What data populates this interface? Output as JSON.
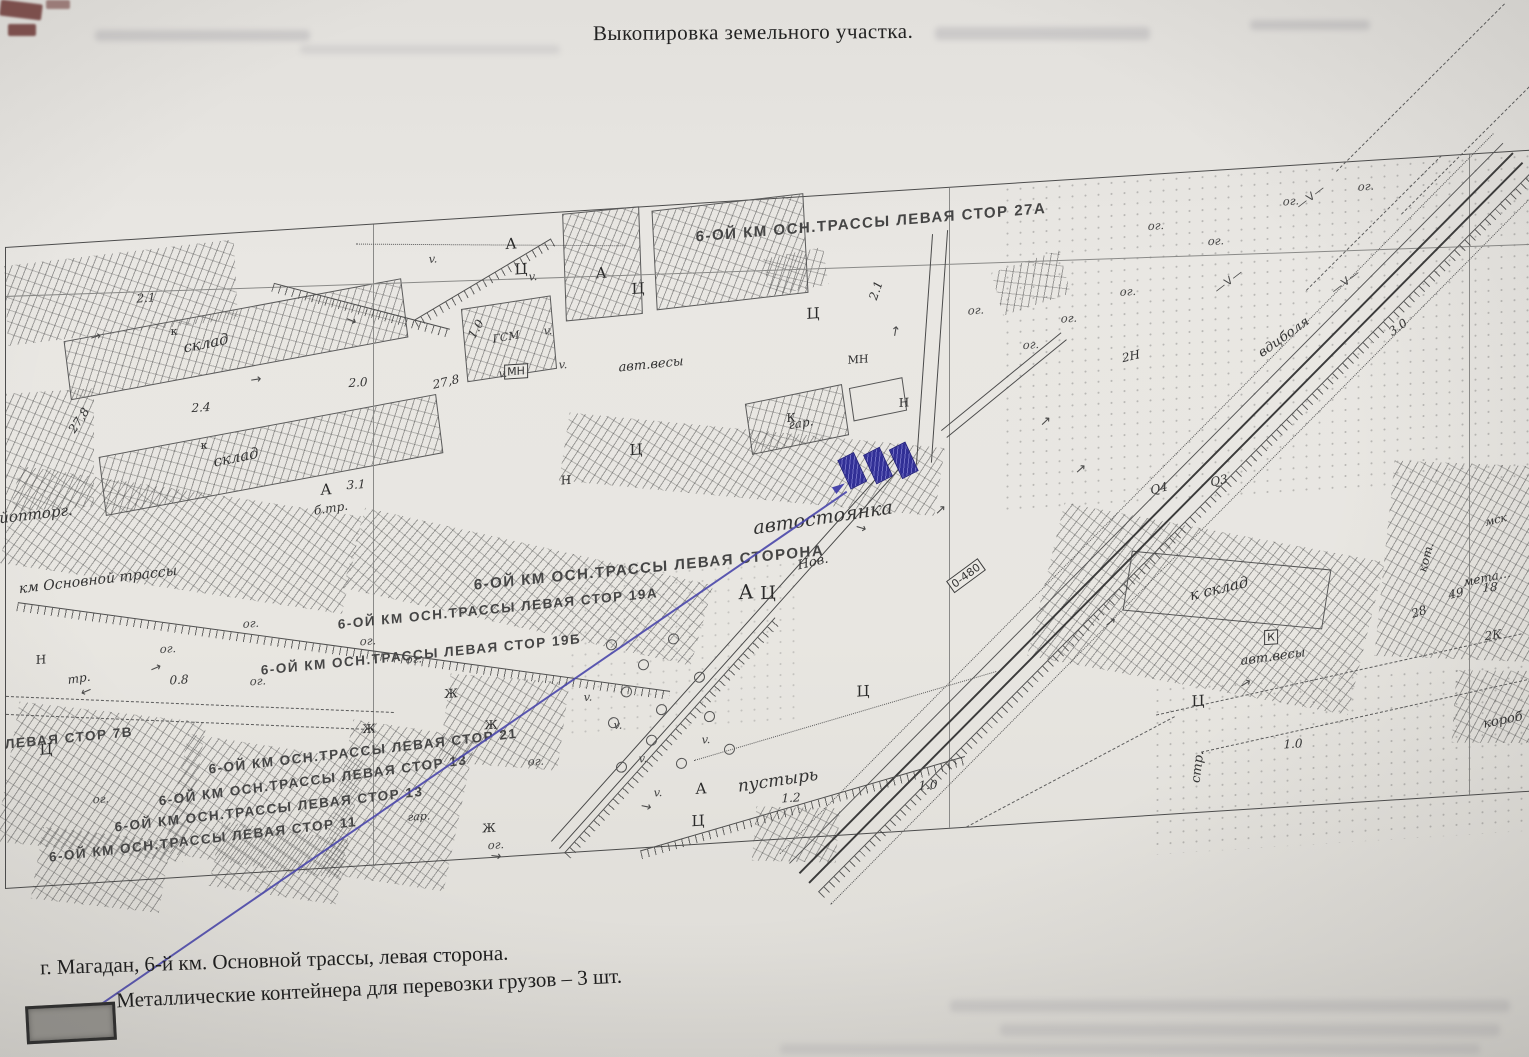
{
  "document": {
    "title": "Выкопировка земельного участка.",
    "footer_lines": [
      "г. Магадан, 6-й км. Основной трассы, левая сторона.",
      "Металлические контейнера для перевозки грузов – 3 шт."
    ]
  },
  "map": {
    "highlight": {
      "containers_count": 3,
      "fill_color": "#34319b",
      "pointer_color": "#4946ab"
    },
    "labels": [
      {
        "t": "6-ОЙ КМ ОСН.ТРАССЫ ЛЕВАЯ СТОР 27А",
        "x": 865,
        "y": 30,
        "r": -1,
        "s": 15,
        "c": "st"
      },
      {
        "t": "6-ОЙ КМ ОСН.ТРАССЫ ЛЕВАЯ СТОРОНА",
        "x": 643,
        "y": 361,
        "r": -2,
        "s": 15,
        "c": "st"
      },
      {
        "t": "6-ОЙ КМ ОСН.ТРАССЫ ЛЕВАЯ СТОР 19А",
        "x": 492,
        "y": 392,
        "r": -2,
        "s": 13.5,
        "c": "st"
      },
      {
        "t": "6-ОЙ КМ ОСН.ТРАССЫ ЛЕВАЯ СТОР 19Б",
        "x": 415,
        "y": 433,
        "r": -2,
        "s": 13.5,
        "c": "st"
      },
      {
        "t": "ЛЕВАЯ СТОР 7В",
        "x": 63,
        "y": 494,
        "r": -2,
        "s": 13.5,
        "c": "st"
      },
      {
        "t": "6-ОЙ КМ ОСН.ТРАССЫ ЛЕВАЯ СТОР 21",
        "x": 357,
        "y": 526,
        "r": -3,
        "s": 13.5,
        "c": "st"
      },
      {
        "t": "6-ОЙ КМ ОСН.ТРАССЫ ЛЕВАЯ СТОР 13",
        "x": 307,
        "y": 552,
        "r": -4,
        "s": 13.5,
        "c": "st"
      },
      {
        "t": "6-ОЙ КМ ОСН.ТРАССЫ ЛЕВАЯ СТОР 13",
        "x": 263,
        "y": 578,
        "r": -3,
        "s": 13.5,
        "c": "st"
      },
      {
        "t": "6-ОЙ КМ ОСН.ТРАССЫ ЛЕВАЯ СТОР 11",
        "x": 197,
        "y": 604,
        "r": -3,
        "s": 13.5,
        "c": "st"
      },
      {
        "t": "автостоянка",
        "x": 817,
        "y": 322,
        "r": -5,
        "s": 19,
        "c": "it"
      },
      {
        "t": "пустырь",
        "x": 772,
        "y": 582,
        "r": -5,
        "s": 17,
        "c": "it"
      },
      {
        "t": "склад",
        "x": 200,
        "y": 108,
        "r": -8,
        "s": 15,
        "c": "it"
      },
      {
        "t": "склад",
        "x": 230,
        "y": 224,
        "r": -8,
        "s": 15,
        "c": "it"
      },
      {
        "t": "к склад",
        "x": 1213,
        "y": 418,
        "r": -10,
        "s": 15,
        "c": "it"
      },
      {
        "t": "км Основной трассы",
        "x": 92,
        "y": 338,
        "r": -3,
        "s": 14,
        "c": "it"
      },
      {
        "t": "авт.весы",
        "x": 645,
        "y": 158,
        "r": -2,
        "s": 13,
        "c": "it"
      },
      {
        "t": "авт.весы",
        "x": 1267,
        "y": 490,
        "r": -4,
        "s": 13,
        "c": "it"
      },
      {
        "t": "гар.",
        "x": 795,
        "y": 226,
        "r": -6,
        "s": 12,
        "c": "it"
      },
      {
        "t": "гар.",
        "x": 413,
        "y": 595,
        "r": 0,
        "s": 11,
        "c": "it"
      },
      {
        "t": "Нов.",
        "x": 807,
        "y": 366,
        "r": -10,
        "s": 13,
        "c": "it"
      },
      {
        "t": "стр.",
        "x": 1192,
        "y": 595,
        "r": -83,
        "s": 13,
        "c": "it"
      },
      {
        "t": "тр.",
        "x": 73,
        "y": 435,
        "r": -5,
        "s": 12,
        "c": "it"
      },
      {
        "t": "б.тр.",
        "x": 325,
        "y": 281,
        "r": -5,
        "s": 12,
        "c": "it"
      },
      {
        "t": "йопторг.",
        "x": 30,
        "y": 268,
        "r": -3,
        "s": 15,
        "c": "it"
      },
      {
        "t": "ГСМ",
        "x": 500,
        "y": 121,
        "r": -6,
        "s": 11,
        "c": "it"
      },
      {
        "t": "кот.",
        "x": 1420,
        "y": 400,
        "r": -75,
        "s": 12,
        "c": "it"
      },
      {
        "t": "мск",
        "x": 1490,
        "y": 367,
        "r": -10,
        "s": 11,
        "c": "it"
      },
      {
        "t": "мета…",
        "x": 1481,
        "y": 424,
        "r": -8,
        "s": 12,
        "c": "it"
      },
      {
        "t": "короб",
        "x": 1497,
        "y": 568,
        "r": -8,
        "s": 13,
        "c": "it"
      },
      {
        "t": "вдцболя",
        "x": 1278,
        "y": 171,
        "r": -33,
        "s": 13,
        "c": "it"
      },
      {
        "t": "2.1",
        "x": 140,
        "y": 59,
        "c": "num"
      },
      {
        "t": "2.4",
        "x": 195,
        "y": 172,
        "c": "num"
      },
      {
        "t": "2.0",
        "x": 352,
        "y": 157,
        "c": "num"
      },
      {
        "t": "3.1",
        "x": 350,
        "y": 259,
        "c": "num"
      },
      {
        "t": "27,8",
        "x": 73,
        "y": 177,
        "r": -55,
        "c": "num"
      },
      {
        "t": "27,8",
        "x": 440,
        "y": 162,
        "r": -10,
        "c": "num"
      },
      {
        "t": "1.0",
        "x": 470,
        "y": 111,
        "r": -60,
        "c": "num"
      },
      {
        "t": "2.1",
        "x": 870,
        "y": 98,
        "r": -70,
        "c": "num"
      },
      {
        "t": "0.8",
        "x": 173,
        "y": 443,
        "c": "num"
      },
      {
        "t": "1.0",
        "x": 922,
        "y": 596,
        "c": "num"
      },
      {
        "t": "1.0",
        "x": 1287,
        "y": 578,
        "c": "num"
      },
      {
        "t": "1.2",
        "x": 785,
        "y": 600,
        "c": "num"
      },
      {
        "t": "3.0",
        "x": 1392,
        "y": 168,
        "r": -33,
        "c": "num"
      },
      {
        "t": "2Н",
        "x": 1125,
        "y": 180,
        "r": -10,
        "c": "num"
      },
      {
        "t": "28",
        "x": 1413,
        "y": 454,
        "r": -15,
        "c": "num"
      },
      {
        "t": "49",
        "x": 1450,
        "y": 438,
        "r": -10,
        "c": "num"
      },
      {
        "t": "18",
        "x": 1484,
        "y": 434,
        "c": "num"
      },
      {
        "t": "2К",
        "x": 1487,
        "y": 482,
        "r": -5,
        "c": "num"
      },
      {
        "t": "Q4",
        "x": 1153,
        "y": 314,
        "r": -10,
        "c": "num"
      },
      {
        "t": "Q3",
        "x": 1213,
        "y": 310,
        "r": -10,
        "c": "num"
      },
      {
        "t": "0-480",
        "x": 960,
        "y": 389,
        "r": -34,
        "c": "box"
      },
      {
        "t": "МН",
        "x": 510,
        "y": 156,
        "c": "box"
      },
      {
        "t": "К",
        "x": 1265,
        "y": 470,
        "c": "box"
      },
      {
        "t": "А",
        "x": 505,
        "y": 28,
        "c": "ltr"
      },
      {
        "t": "А",
        "x": 595,
        "y": 63,
        "c": "ltr"
      },
      {
        "t": "А",
        "x": 320,
        "y": 262,
        "c": "ltr"
      },
      {
        "t": "А",
        "x": 740,
        "y": 391,
        "s": 20,
        "c": "ltr"
      },
      {
        "t": "А",
        "x": 695,
        "y": 585,
        "c": "ltr"
      },
      {
        "t": "Ц",
        "x": 515,
        "y": 54,
        "c": "ltr"
      },
      {
        "t": "Ц",
        "x": 632,
        "y": 81,
        "c": "ltr"
      },
      {
        "t": "Ц",
        "x": 807,
        "y": 117,
        "c": "ltr"
      },
      {
        "t": "Ц",
        "x": 630,
        "y": 242,
        "c": "ltr"
      },
      {
        "t": "Ц",
        "x": 762,
        "y": 394,
        "s": 18,
        "c": "ltr"
      },
      {
        "t": "Ц",
        "x": 692,
        "y": 617,
        "c": "ltr"
      },
      {
        "t": "Ц",
        "x": 857,
        "y": 498,
        "c": "ltr"
      },
      {
        "t": "Ц",
        "x": 1192,
        "y": 529,
        "c": "ltr"
      },
      {
        "t": "Ц",
        "x": 40,
        "y": 504,
        "c": "ltr"
      },
      {
        "t": "Ж",
        "x": 363,
        "y": 504,
        "s": 12,
        "c": "ltr"
      },
      {
        "t": "Ж",
        "x": 485,
        "y": 508,
        "s": 12,
        "c": "ltr"
      },
      {
        "t": "Ж",
        "x": 483,
        "y": 611,
        "s": 12,
        "c": "ltr"
      },
      {
        "t": "Ж",
        "x": 445,
        "y": 474,
        "s": 12,
        "c": "ltr"
      },
      {
        "t": "Н",
        "x": 35,
        "y": 414,
        "s": 12,
        "c": "ltr"
      },
      {
        "t": "Н",
        "x": 898,
        "y": 212,
        "s": 12,
        "c": "ltr"
      },
      {
        "t": "Н",
        "x": 560,
        "y": 268,
        "s": 12,
        "c": "ltr"
      },
      {
        "t": "К",
        "x": 785,
        "y": 220,
        "s": 12,
        "c": "ltr"
      },
      {
        "t": "МН",
        "x": 852,
        "y": 166,
        "s": 11,
        "c": "ltr"
      },
      {
        "t": "к",
        "x": 168,
        "y": 94,
        "s": 11,
        "c": "ltr"
      },
      {
        "t": "к",
        "x": 198,
        "y": 210,
        "s": 11,
        "c": "ltr"
      },
      {
        "t": "ог.",
        "x": 245,
        "y": 391,
        "c": "og"
      },
      {
        "t": "ог.",
        "x": 362,
        "y": 416,
        "c": "og"
      },
      {
        "t": "ог.",
        "x": 162,
        "y": 411,
        "c": "og"
      },
      {
        "t": "ог.",
        "x": 252,
        "y": 449,
        "c": "og"
      },
      {
        "t": "ог.",
        "x": 408,
        "y": 437,
        "c": "og"
      },
      {
        "t": "ог.",
        "x": 95,
        "y": 557,
        "c": "og"
      },
      {
        "t": "ог.",
        "x": 530,
        "y": 547,
        "c": "og"
      },
      {
        "t": "ог.",
        "x": 490,
        "y": 628,
        "c": "og"
      },
      {
        "t": "ог.",
        "x": 1063,
        "y": 138,
        "c": "og"
      },
      {
        "t": "ог.",
        "x": 1122,
        "y": 115,
        "c": "og"
      },
      {
        "t": "ог.",
        "x": 1025,
        "y": 162,
        "c": "og"
      },
      {
        "t": "ог.",
        "x": 1150,
        "y": 51,
        "c": "og"
      },
      {
        "t": "ог.",
        "x": 1285,
        "y": 35,
        "c": "og"
      },
      {
        "t": "ог.",
        "x": 1360,
        "y": 25,
        "c": "og"
      },
      {
        "t": "ог.",
        "x": 970,
        "y": 124,
        "c": "og"
      },
      {
        "t": "ог.",
        "x": 1210,
        "y": 70,
        "c": "og"
      },
      {
        "t": "v.",
        "x": 427,
        "y": 38,
        "c": "og"
      },
      {
        "t": "v.",
        "x": 527,
        "y": 62,
        "c": "og"
      },
      {
        "t": "v.",
        "x": 542,
        "y": 117,
        "c": "og"
      },
      {
        "t": "v.",
        "x": 497,
        "y": 157,
        "c": "og"
      },
      {
        "t": "v.",
        "x": 557,
        "y": 152,
        "c": "og"
      },
      {
        "t": "v.",
        "x": 582,
        "y": 486,
        "c": "og"
      },
      {
        "t": "v.",
        "x": 612,
        "y": 516,
        "c": "og"
      },
      {
        "t": "v.",
        "x": 637,
        "y": 551,
        "c": "og"
      },
      {
        "t": "v.",
        "x": 700,
        "y": 536,
        "c": "og"
      },
      {
        "t": "v.",
        "x": 652,
        "y": 586,
        "c": "og"
      },
      {
        "t": "—V—",
        "x": 1223,
        "y": 111,
        "r": -35,
        "s": 11,
        "c": "vl"
      },
      {
        "t": "—V—",
        "x": 1305,
        "y": 32,
        "r": -35,
        "s": 11,
        "c": "vl"
      },
      {
        "t": "—V—",
        "x": 1340,
        "y": 119,
        "r": -35,
        "s": 11,
        "c": "vl"
      }
    ]
  }
}
